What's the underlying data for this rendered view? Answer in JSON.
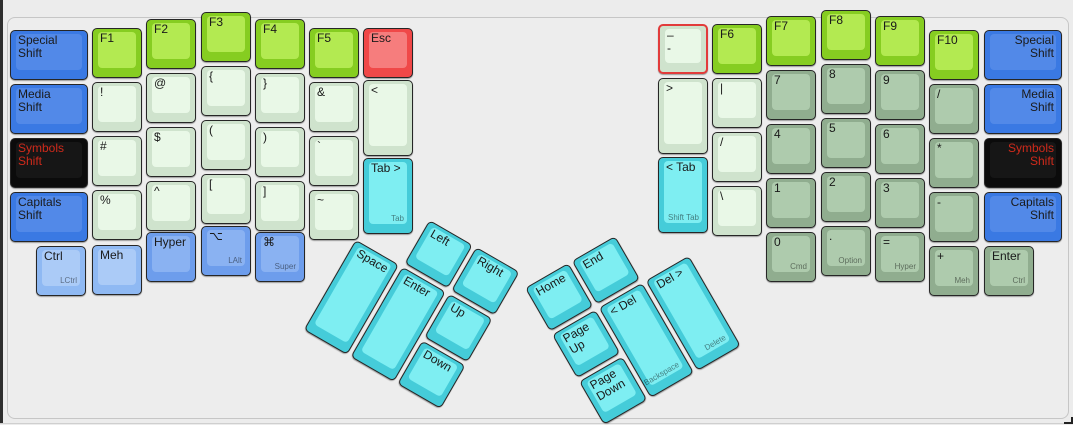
{
  "app": {
    "title": "keyboard layout editor canvas"
  },
  "colors": {
    "background": "#ececec",
    "shift_blue": "#3a79e3",
    "modifier_light_blue": "#8fb9f3",
    "modifier_mid_blue": "#6d9dec",
    "symbols_black": "#0b0b0b",
    "symbols_red_text": "#cf2a1b",
    "fn_green": "#86cd21",
    "symbol_pale_green": "#cfe3cd",
    "numpad_sage_green": "#90ad8f",
    "thumb_cyan": "#45ccd9",
    "esc_red": "#f04848",
    "selected_outline": "#e23b3b"
  },
  "keys": [
    {
      "name": "special-shift-left",
      "label": "Special\nShift",
      "color": "blue",
      "cluster": "main",
      "x": 10,
      "y": 30,
      "w": 78,
      "h": 50
    },
    {
      "name": "media-shift-left",
      "label": "Media\nShift",
      "color": "blue",
      "cluster": "main",
      "x": 10,
      "y": 84,
      "w": 78,
      "h": 50
    },
    {
      "name": "symbols-shift-left",
      "label": "Symbols\nShift",
      "color": "black",
      "cluster": "main",
      "x": 10,
      "y": 138,
      "w": 78,
      "h": 50
    },
    {
      "name": "capitals-shift-left",
      "label": "Capitals\nShift",
      "color": "blue",
      "cluster": "main",
      "x": 10,
      "y": 192,
      "w": 78,
      "h": 50
    },
    {
      "name": "f1",
      "label": "F1",
      "color": "green",
      "cluster": "main",
      "x": 92,
      "y": 28,
      "w": 50,
      "h": 50
    },
    {
      "name": "exclamation",
      "label": "!",
      "color": "pale",
      "cluster": "main",
      "x": 92,
      "y": 82,
      "w": 50,
      "h": 50
    },
    {
      "name": "hash",
      "label": "#",
      "color": "pale",
      "cluster": "main",
      "x": 92,
      "y": 136,
      "w": 50,
      "h": 50
    },
    {
      "name": "percent",
      "label": "%",
      "color": "pale",
      "cluster": "main",
      "x": 92,
      "y": 190,
      "w": 50,
      "h": 50
    },
    {
      "name": "f2",
      "label": "F2",
      "color": "green",
      "cluster": "main",
      "x": 146,
      "y": 19,
      "w": 50,
      "h": 50
    },
    {
      "name": "at",
      "label": "@",
      "color": "pale",
      "cluster": "main",
      "x": 146,
      "y": 73,
      "w": 50,
      "h": 50
    },
    {
      "name": "dollar",
      "label": "$",
      "color": "pale",
      "cluster": "main",
      "x": 146,
      "y": 127,
      "w": 50,
      "h": 50
    },
    {
      "name": "caret",
      "label": "^",
      "color": "pale",
      "cluster": "main",
      "x": 146,
      "y": 181,
      "w": 50,
      "h": 50
    },
    {
      "name": "f3",
      "label": "F3",
      "color": "green",
      "cluster": "main",
      "x": 201,
      "y": 12,
      "w": 50,
      "h": 50
    },
    {
      "name": "brace-open",
      "label": "{",
      "color": "pale",
      "cluster": "main",
      "x": 201,
      "y": 66,
      "w": 50,
      "h": 50
    },
    {
      "name": "paren-open",
      "label": "(",
      "color": "pale",
      "cluster": "main",
      "x": 201,
      "y": 120,
      "w": 50,
      "h": 50
    },
    {
      "name": "bracket-open",
      "label": "[",
      "color": "pale",
      "cluster": "main",
      "x": 201,
      "y": 174,
      "w": 50,
      "h": 50
    },
    {
      "name": "f4",
      "label": "F4",
      "color": "green",
      "cluster": "main",
      "x": 255,
      "y": 19,
      "w": 50,
      "h": 50
    },
    {
      "name": "brace-close",
      "label": "}",
      "color": "pale",
      "cluster": "main",
      "x": 255,
      "y": 73,
      "w": 50,
      "h": 50
    },
    {
      "name": "paren-close",
      "label": ")",
      "color": "pale",
      "cluster": "main",
      "x": 255,
      "y": 127,
      "w": 50,
      "h": 50
    },
    {
      "name": "bracket-close",
      "label": "]",
      "color": "pale",
      "cluster": "main",
      "x": 255,
      "y": 181,
      "w": 50,
      "h": 50
    },
    {
      "name": "f5",
      "label": "F5",
      "color": "green",
      "cluster": "main",
      "x": 309,
      "y": 28,
      "w": 50,
      "h": 50
    },
    {
      "name": "ampersand",
      "label": "&",
      "color": "pale",
      "cluster": "main",
      "x": 309,
      "y": 82,
      "w": 50,
      "h": 50
    },
    {
      "name": "backtick",
      "label": "`",
      "color": "pale",
      "cluster": "main",
      "x": 309,
      "y": 136,
      "w": 50,
      "h": 50
    },
    {
      "name": "tilde",
      "label": "~",
      "color": "pale",
      "cluster": "main",
      "x": 309,
      "y": 190,
      "w": 50,
      "h": 50
    },
    {
      "name": "esc",
      "label": "Esc",
      "color": "red",
      "cluster": "main",
      "x": 363,
      "y": 28,
      "w": 50,
      "h": 50
    },
    {
      "name": "less-than",
      "label": "<",
      "color": "pale",
      "cluster": "main",
      "x": 363,
      "y": 80,
      "w": 50,
      "h": 76
    },
    {
      "name": "tab-forward",
      "label": "Tab >",
      "front": "Tab",
      "color": "cyan",
      "cluster": "main",
      "x": 363,
      "y": 158,
      "w": 50,
      "h": 76
    },
    {
      "name": "ctrl-left",
      "label": "Ctrl",
      "front": "LCtrl",
      "color": "lblue",
      "cluster": "main",
      "x": 36,
      "y": 246,
      "w": 50,
      "h": 50
    },
    {
      "name": "meh-left",
      "label": "Meh",
      "color": "lblue",
      "cluster": "main",
      "x": 92,
      "y": 245,
      "w": 50,
      "h": 50
    },
    {
      "name": "hyper-left",
      "label": "Hyper",
      "color": "mblue",
      "cluster": "main",
      "x": 146,
      "y": 232,
      "w": 50,
      "h": 50
    },
    {
      "name": "lalt",
      "label": "⌥",
      "front": "LAlt",
      "color": "mblue",
      "cluster": "main",
      "x": 201,
      "y": 226,
      "w": 50,
      "h": 50
    },
    {
      "name": "super",
      "label": "⌘",
      "front": "Super",
      "color": "mblue",
      "cluster": "main",
      "x": 255,
      "y": 232,
      "w": 50,
      "h": 50
    },
    {
      "name": "dash-selected",
      "label": "–\n-",
      "color": "pale",
      "cluster": "main",
      "selected": true,
      "x": 658,
      "y": 24,
      "w": 50,
      "h": 50
    },
    {
      "name": "greater-than",
      "label": ">",
      "color": "pale",
      "cluster": "main",
      "x": 658,
      "y": 78,
      "w": 50,
      "h": 76
    },
    {
      "name": "tab-back",
      "label": "< Tab",
      "front": "Shift Tab",
      "color": "cyan",
      "cluster": "main",
      "x": 658,
      "y": 157,
      "w": 50,
      "h": 76
    },
    {
      "name": "f6",
      "label": "F6",
      "color": "green",
      "cluster": "main",
      "x": 712,
      "y": 24,
      "w": 50,
      "h": 50
    },
    {
      "name": "pipe",
      "label": "|",
      "color": "pale",
      "cluster": "main",
      "x": 712,
      "y": 78,
      "w": 50,
      "h": 50
    },
    {
      "name": "slash-pale",
      "label": "/",
      "color": "pale",
      "cluster": "main",
      "x": 712,
      "y": 132,
      "w": 50,
      "h": 50
    },
    {
      "name": "backslash",
      "label": "\\",
      "color": "pale",
      "cluster": "main",
      "x": 712,
      "y": 186,
      "w": 50,
      "h": 50
    },
    {
      "name": "f7",
      "label": "F7",
      "color": "green",
      "cluster": "main",
      "x": 766,
      "y": 16,
      "w": 50,
      "h": 50
    },
    {
      "name": "num-7",
      "label": "7",
      "color": "sage",
      "cluster": "main",
      "x": 766,
      "y": 70,
      "w": 50,
      "h": 50
    },
    {
      "name": "num-4",
      "label": "4",
      "color": "sage",
      "cluster": "main",
      "x": 766,
      "y": 124,
      "w": 50,
      "h": 50
    },
    {
      "name": "num-1",
      "label": "1",
      "color": "sage",
      "cluster": "main",
      "x": 766,
      "y": 178,
      "w": 50,
      "h": 50
    },
    {
      "name": "num-0",
      "label": "0",
      "front": "Cmd",
      "color": "sage",
      "cluster": "main",
      "x": 766,
      "y": 232,
      "w": 50,
      "h": 50
    },
    {
      "name": "f8",
      "label": "F8",
      "color": "green",
      "cluster": "main",
      "x": 821,
      "y": 10,
      "w": 50,
      "h": 50
    },
    {
      "name": "num-8",
      "label": "8",
      "color": "sage",
      "cluster": "main",
      "x": 821,
      "y": 64,
      "w": 50,
      "h": 50
    },
    {
      "name": "num-5",
      "label": "5",
      "color": "sage",
      "cluster": "main",
      "x": 821,
      "y": 118,
      "w": 50,
      "h": 50
    },
    {
      "name": "num-2",
      "label": "2",
      "color": "sage",
      "cluster": "main",
      "x": 821,
      "y": 172,
      "w": 50,
      "h": 50
    },
    {
      "name": "num-period",
      "label": ".",
      "front": "Option",
      "color": "sage",
      "cluster": "main",
      "x": 821,
      "y": 226,
      "w": 50,
      "h": 50
    },
    {
      "name": "f9",
      "label": "F9",
      "color": "green",
      "cluster": "main",
      "x": 875,
      "y": 16,
      "w": 50,
      "h": 50
    },
    {
      "name": "num-9",
      "label": "9",
      "color": "sage",
      "cluster": "main",
      "x": 875,
      "y": 70,
      "w": 50,
      "h": 50
    },
    {
      "name": "num-6",
      "label": "6",
      "color": "sage",
      "cluster": "main",
      "x": 875,
      "y": 124,
      "w": 50,
      "h": 50
    },
    {
      "name": "num-3",
      "label": "3",
      "color": "sage",
      "cluster": "main",
      "x": 875,
      "y": 178,
      "w": 50,
      "h": 50
    },
    {
      "name": "num-equals",
      "label": "=",
      "front": "Hyper",
      "color": "sage",
      "cluster": "main",
      "x": 875,
      "y": 232,
      "w": 50,
      "h": 50
    },
    {
      "name": "f10",
      "label": "F10",
      "color": "green",
      "cluster": "main",
      "x": 929,
      "y": 30,
      "w": 50,
      "h": 50
    },
    {
      "name": "num-divide",
      "label": "/",
      "color": "sage",
      "cluster": "main",
      "x": 929,
      "y": 84,
      "w": 50,
      "h": 50
    },
    {
      "name": "num-multiply",
      "label": "*",
      "color": "sage",
      "cluster": "main",
      "x": 929,
      "y": 138,
      "w": 50,
      "h": 50
    },
    {
      "name": "num-minus",
      "label": "-",
      "color": "sage",
      "cluster": "main",
      "x": 929,
      "y": 192,
      "w": 50,
      "h": 50
    },
    {
      "name": "num-plus",
      "label": "+",
      "front": "Meh",
      "color": "sage",
      "cluster": "main",
      "x": 929,
      "y": 246,
      "w": 50,
      "h": 50
    },
    {
      "name": "special-shift-right",
      "label": "Special\nShift",
      "color": "blue",
      "cluster": "main",
      "align": "right",
      "x": 984,
      "y": 30,
      "w": 78,
      "h": 50
    },
    {
      "name": "media-shift-right",
      "label": "Media\nShift",
      "color": "blue",
      "cluster": "main",
      "align": "right",
      "x": 984,
      "y": 84,
      "w": 78,
      "h": 50
    },
    {
      "name": "symbols-shift-right",
      "label": "Symbols\nShift",
      "color": "black",
      "cluster": "main",
      "align": "right",
      "x": 984,
      "y": 138,
      "w": 78,
      "h": 50
    },
    {
      "name": "capitals-shift-right",
      "label": "Capitals\nShift",
      "color": "blue",
      "cluster": "main",
      "align": "right",
      "x": 984,
      "y": 192,
      "w": 78,
      "h": 50
    },
    {
      "name": "numpad-enter",
      "label": "Enter",
      "front": "Ctrl",
      "color": "sage",
      "cluster": "main",
      "x": 984,
      "y": 246,
      "w": 50,
      "h": 50
    },
    {
      "name": "space",
      "label": "Space",
      "color": "cyan",
      "cluster": "left-thumb",
      "x": 54,
      "y": 54,
      "w": 50,
      "h": 104
    },
    {
      "name": "enter",
      "label": "Enter",
      "color": "cyan",
      "cluster": "left-thumb",
      "x": 108,
      "y": 54,
      "w": 50,
      "h": 104
    },
    {
      "name": "arrow-left",
      "label": "Left",
      "color": "cyan",
      "cluster": "left-thumb",
      "x": 108,
      "y": 0,
      "w": 50,
      "h": 50
    },
    {
      "name": "arrow-right",
      "label": "Right",
      "color": "cyan",
      "cluster": "left-thumb",
      "x": 162,
      "y": 0,
      "w": 50,
      "h": 50
    },
    {
      "name": "arrow-up",
      "label": "Up",
      "color": "cyan",
      "cluster": "left-thumb",
      "x": 162,
      "y": 54,
      "w": 50,
      "h": 50
    },
    {
      "name": "arrow-down",
      "label": "Down",
      "color": "cyan",
      "cluster": "left-thumb",
      "x": 162,
      "y": 108,
      "w": 50,
      "h": 50
    },
    {
      "name": "home",
      "label": "Home",
      "color": "cyan",
      "cluster": "right-thumb",
      "x": 0,
      "y": 0,
      "w": 50,
      "h": 50
    },
    {
      "name": "end",
      "label": "End",
      "color": "cyan",
      "cluster": "right-thumb",
      "x": 54,
      "y": 0,
      "w": 50,
      "h": 50
    },
    {
      "name": "page-up",
      "label": "Page\nUp",
      "color": "cyan",
      "cluster": "right-thumb",
      "x": 0,
      "y": 54,
      "w": 50,
      "h": 50
    },
    {
      "name": "page-down",
      "label": "Page\nDown",
      "color": "cyan",
      "cluster": "right-thumb",
      "x": 0,
      "y": 108,
      "w": 50,
      "h": 50
    },
    {
      "name": "backspace",
      "label": "< Del",
      "front": "Backspace",
      "color": "cyan",
      "cluster": "right-thumb",
      "x": 54,
      "y": 54,
      "w": 50,
      "h": 104
    },
    {
      "name": "delete",
      "label": "Del >",
      "front": "Delete",
      "color": "cyan",
      "cluster": "right-thumb",
      "x": 108,
      "y": 54,
      "w": 50,
      "h": 104
    }
  ]
}
